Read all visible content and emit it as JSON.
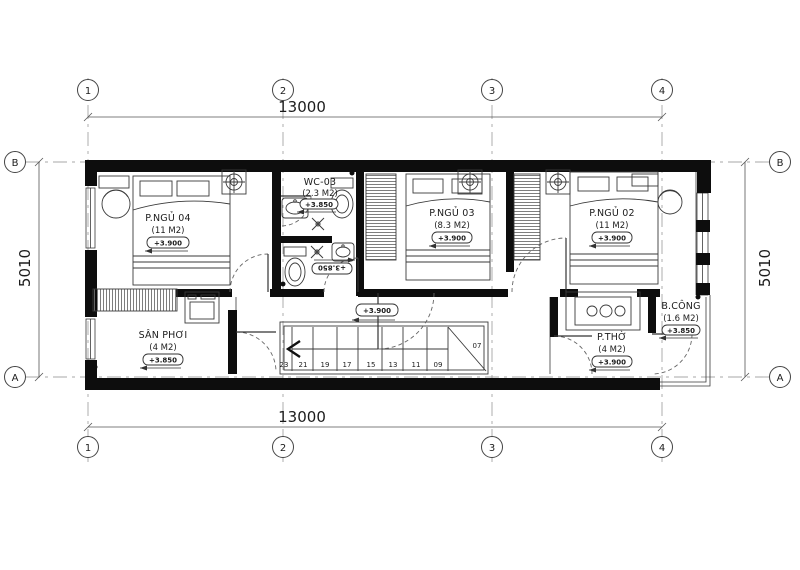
{
  "grid": {
    "cols": [
      "1",
      "2",
      "3",
      "4"
    ],
    "rows": [
      "B",
      "A"
    ]
  },
  "dims": {
    "top": "13000",
    "bottom": "13000",
    "left": "5010",
    "right": "5010"
  },
  "rooms": {
    "bedroom4": {
      "name": "P.NGỦ 04",
      "area": "(11 M2)",
      "level": "+3.900"
    },
    "wc": {
      "name": "WC-03",
      "area": "(2.3 M2)",
      "level": "+3.850"
    },
    "bedroom3": {
      "name": "P.NGỦ 03",
      "area": "(8.3 M2)",
      "level": "+3.900"
    },
    "bedroom2": {
      "name": "P.NGỦ 02",
      "area": "(11 M2)",
      "level": "+3.900"
    },
    "laundry": {
      "name": "SÂN PHƠI",
      "area": "(4 M2)",
      "level": "+3.850"
    },
    "worship": {
      "name": "P.THỜ",
      "area": "(4 M2)",
      "level": "+3.900"
    },
    "balcony": {
      "name": "B.CÔNG",
      "area": "(1.6 M2)",
      "level": "+3.850"
    }
  },
  "wc_lower": {
    "level": "+3.850"
  },
  "hall": {
    "level": "+3.900"
  },
  "stairs": {
    "numbers": [
      "23",
      "21",
      "19",
      "17",
      "15",
      "13",
      "11",
      "09"
    ],
    "top": "07"
  }
}
